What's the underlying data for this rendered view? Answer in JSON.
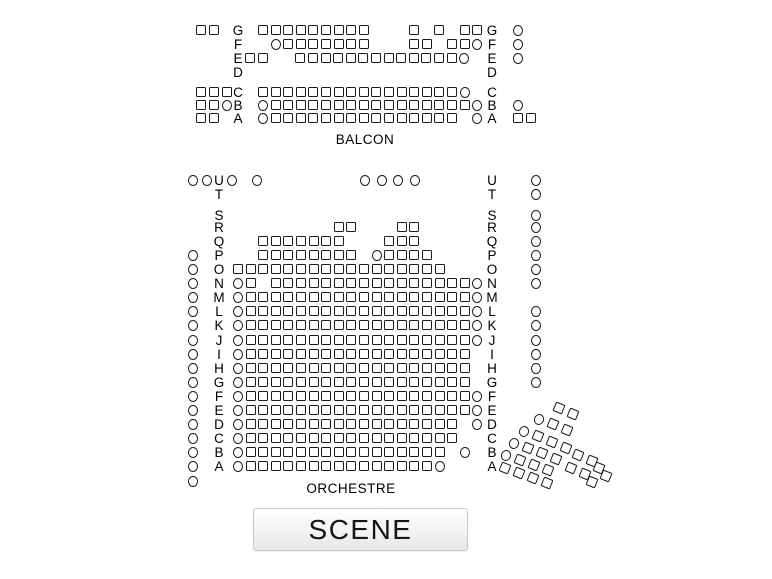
{
  "canvas": {
    "width": 772,
    "height": 579,
    "background": "#ffffff"
  },
  "stage": {
    "label": "SCENE",
    "x": 253,
    "y": 508,
    "width": 213,
    "height": 41
  },
  "pattern_key": {
    "s": "square-seat",
    "o": "round-seat",
    ".": "empty-slot"
  },
  "seat_style": {
    "fill": "#ffffff",
    "border": "#1c1c1c",
    "size": 10
  },
  "sections": {
    "balcony": {
      "title": "BALCON",
      "title_x": 365,
      "title_y": 132,
      "left_label_x": 238,
      "right_label_x": 492,
      "outer_left_x": 196,
      "outer_right_x": 513,
      "outer_pitch": 13.2,
      "x0": 258,
      "pitch": 12.6,
      "rows": [
        {
          "label": "G",
          "y": 25,
          "outer_left": "ss",
          "pattern": "sssssssss...s.s.ss",
          "outer_right": "o"
        },
        {
          "label": "F",
          "y": 39,
          "outer_left": "",
          "pattern": ".osssssss...ss.sso",
          "outer_right": "o"
        },
        {
          "label": "E",
          "y": 53,
          "outer_left": "",
          "x0": 245,
          "pattern": "ss..ssssssssssssso",
          "outer_right": "o"
        },
        {
          "label": "D",
          "y": 67,
          "outer_left": "",
          "pattern": "",
          "outer_right": ""
        },
        {
          "label": "C",
          "y": 87,
          "outer_left": "sss",
          "pattern": "sssssssssssssssso",
          "outer_right": ""
        },
        {
          "label": "B",
          "y": 100,
          "outer_left": "sso",
          "pattern": "osssssssssssssssso",
          "outer_right": "o"
        },
        {
          "label": "A",
          "y": 113,
          "outer_left": "ss",
          "pattern": "osssssssssssssss.o",
          "outer_right": "ss"
        }
      ]
    },
    "orchestra": {
      "title": "ORCHESTRE",
      "title_x": 351,
      "title_y": 481,
      "left_label_x": 219,
      "right_label_x": 492,
      "outer_left_x": 188,
      "outer_right_x": 531,
      "outer_pitch": 13.5,
      "x0": 233,
      "pitch": 12.6,
      "rows": [
        {
          "label": "U",
          "y": 175,
          "outer_left": "oo",
          "pattern": "",
          "seats": [
            {
              "t": "o",
              "x": 227
            },
            {
              "t": "o",
              "x": 252
            },
            {
              "t": "o",
              "x": 360
            },
            {
              "t": "o",
              "x": 377
            },
            {
              "t": "o",
              "x": 393
            },
            {
              "t": "o",
              "x": 410
            }
          ],
          "outer_right": "o"
        },
        {
          "label": "T",
          "y": 189,
          "outer_left": "",
          "pattern": "",
          "outer_right": "o"
        },
        {
          "label": "S",
          "y": 210,
          "outer_left": "",
          "pattern": "",
          "outer_right": "o"
        },
        {
          "label": "R",
          "y": 222,
          "outer_left": "",
          "pattern": "........ss...ss.....",
          "outer_right": "o"
        },
        {
          "label": "Q",
          "y": 236,
          "outer_left": "",
          "pattern": "..sssssss...sss.....",
          "outer_right": "o"
        },
        {
          "label": "P",
          "y": 250,
          "outer_left": "o",
          "pattern": "..ssssssss.ossss....",
          "outer_right": "o"
        },
        {
          "label": "O",
          "y": 264,
          "outer_left": "o",
          "pattern": "sssssssssssssssss...",
          "outer_right": "o"
        },
        {
          "label": "N",
          "y": 278,
          "outer_left": "o",
          "pattern": "os.sssssssssssssssso",
          "outer_right": "o"
        },
        {
          "label": "M",
          "y": 292,
          "outer_left": "o",
          "pattern": "osssssssssssssssssso",
          "outer_right": ""
        },
        {
          "label": "L",
          "y": 306,
          "outer_left": "o",
          "pattern": "osssssssssssssssssso",
          "outer_right": "o"
        },
        {
          "label": "K",
          "y": 320,
          "outer_left": "o",
          "pattern": "osssssssssssssssssso",
          "outer_right": "o"
        },
        {
          "label": "J",
          "y": 335,
          "outer_left": "o",
          "pattern": "osssssssssssssssssso",
          "outer_right": "o"
        },
        {
          "label": "I",
          "y": 349,
          "outer_left": "o",
          "pattern": "ossssssssssssssssss.",
          "outer_right": "o"
        },
        {
          "label": "H",
          "y": 363,
          "outer_left": "o",
          "pattern": "ossssssssssssssssss.",
          "outer_right": "o"
        },
        {
          "label": "G",
          "y": 377,
          "outer_left": "o",
          "pattern": "ossssssssssssssssss.",
          "outer_right": "o"
        },
        {
          "label": "F",
          "y": 391,
          "outer_left": "o",
          "pattern": "osssssssssssssssssso",
          "outer_right": ""
        },
        {
          "label": "E",
          "y": 405,
          "outer_left": "o",
          "pattern": "osssssssssssssssssso",
          "outer_right": ""
        },
        {
          "label": "D",
          "y": 419,
          "outer_left": "o",
          "pattern": "osssssssssssssssss.o",
          "outer_right": ""
        },
        {
          "label": "C",
          "y": 433,
          "outer_left": "o",
          "pattern": "osssssssssssssssss..",
          "outer_right": ""
        },
        {
          "label": "B",
          "y": 447,
          "outer_left": "o",
          "pattern": "ossssssssssssssss.o.",
          "outer_right": ""
        },
        {
          "label": "A",
          "y": 461,
          "outer_left": "o",
          "pattern": "ossssssssssssssso...",
          "outer_right": ""
        }
      ],
      "extra_seats": [
        {
          "t": "o",
          "x": 188,
          "y": 476
        }
      ]
    },
    "side_block": {
      "rotation_deg": 22,
      "seats": [
        {
          "t": "s",
          "x": 554,
          "y": 403
        },
        {
          "t": "s",
          "x": 568,
          "y": 409
        },
        {
          "t": "o",
          "x": 534,
          "y": 414
        },
        {
          "t": "s",
          "x": 548,
          "y": 419
        },
        {
          "t": "s",
          "x": 562,
          "y": 425
        },
        {
          "t": "o",
          "x": 519,
          "y": 426
        },
        {
          "t": "s",
          "x": 533,
          "y": 431
        },
        {
          "t": "s",
          "x": 547,
          "y": 437
        },
        {
          "t": "s",
          "x": 561,
          "y": 443
        },
        {
          "t": "o",
          "x": 509,
          "y": 438
        },
        {
          "t": "s",
          "x": 523,
          "y": 443
        },
        {
          "t": "s",
          "x": 537,
          "y": 448
        },
        {
          "t": "s",
          "x": 551,
          "y": 454
        },
        {
          "t": "o",
          "x": 501,
          "y": 450
        },
        {
          "t": "s",
          "x": 515,
          "y": 455
        },
        {
          "t": "s",
          "x": 529,
          "y": 460
        },
        {
          "t": "s",
          "x": 543,
          "y": 465
        },
        {
          "t": "s",
          "x": 500,
          "y": 463
        },
        {
          "t": "s",
          "x": 514,
          "y": 468
        },
        {
          "t": "s",
          "x": 528,
          "y": 473
        },
        {
          "t": "s",
          "x": 542,
          "y": 478
        },
        {
          "t": "s",
          "x": 573,
          "y": 450
        },
        {
          "t": "s",
          "x": 587,
          "y": 456
        },
        {
          "t": "s",
          "x": 566,
          "y": 463
        },
        {
          "t": "s",
          "x": 580,
          "y": 469
        },
        {
          "t": "s",
          "x": 594,
          "y": 463
        },
        {
          "t": "s",
          "x": 587,
          "y": 477
        },
        {
          "t": "s",
          "x": 601,
          "y": 471
        }
      ]
    }
  }
}
